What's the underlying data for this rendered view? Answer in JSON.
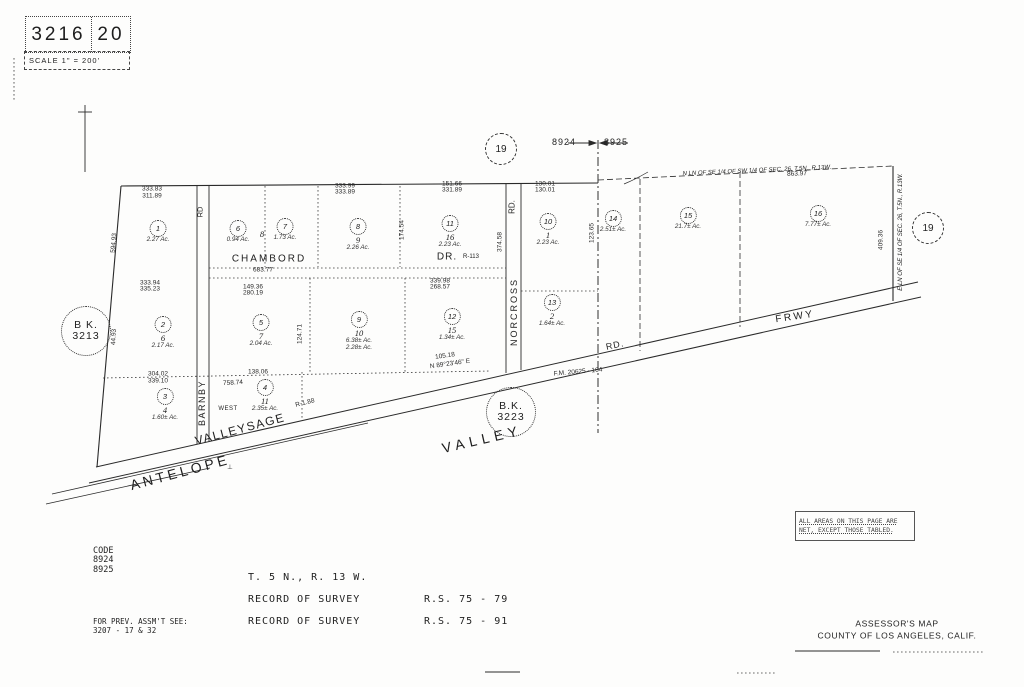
{
  "title_block": {
    "book": "3216",
    "page": "20",
    "scale": "SCALE 1\" = 200'"
  },
  "refs": {
    "map_circle_top": "19",
    "map_circle_right": "19",
    "page_left": "8924",
    "page_right": "8925",
    "bk_left_line1": "B K.",
    "bk_left_line2": "3213",
    "bk_mid_line1": "B.K.",
    "bk_mid_line2": "3223"
  },
  "section_lines": {
    "north": "N LN OF SE 1/4 OF SW 1/4 OF SEC. 26, T.5N., R.13W.",
    "east": "E LN OF SE 1/4 OF SEC. 26, T.5N., R.13W."
  },
  "roads": {
    "chambord": "CHAMBORD",
    "chambord_suffix": "DR.",
    "chambord_note": "R-113",
    "norcross": "NORCROSS",
    "norcross_suffix": "RD.",
    "barnby": "BARNBY",
    "barnby_suffix": "RD",
    "antelope": "ANTELOPE",
    "valley": "VALLEY",
    "valleysage": "VALLEYSAGE",
    "frwy": "FRWY",
    "diag_rd": "RD.",
    "west": "WEST",
    "lot8_label": "8"
  },
  "parcels": [
    {
      "circle": "1",
      "lot": "",
      "area": "2.27 Ac.",
      "x": 158,
      "y": 226
    },
    {
      "circle": "6",
      "lot": "",
      "area": "0.94 Ac.",
      "x": 238,
      "y": 226
    },
    {
      "circle": "7",
      "lot": "",
      "area": "1.73 Ac.",
      "x": 285,
      "y": 224
    },
    {
      "circle": "8",
      "lot": "9",
      "area": "2.26 Ac.",
      "x": 358,
      "y": 224
    },
    {
      "circle": "11",
      "lot": "16",
      "area": "2.23 Ac.",
      "x": 450,
      "y": 221
    },
    {
      "circle": "10",
      "lot": "1",
      "area": "2.23 Ac.",
      "x": 548,
      "y": 219
    },
    {
      "circle": "14",
      "lot": "",
      "area": "2.51± Ac.",
      "x": 613,
      "y": 216
    },
    {
      "circle": "15",
      "lot": "",
      "area": "21.7± Ac.",
      "x": 688,
      "y": 213
    },
    {
      "circle": "16",
      "lot": "",
      "area": "7.77± Ac.",
      "x": 818,
      "y": 211
    },
    {
      "circle": "2",
      "lot": "6",
      "area": "2.17 Ac.",
      "x": 163,
      "y": 322
    },
    {
      "circle": "5",
      "lot": "7",
      "area": "2.04 Ac.",
      "x": 261,
      "y": 320
    },
    {
      "circle": "9",
      "lot": "10",
      "area": "6.38± Ac.",
      "area2": "2.28± Ac.",
      "x": 359,
      "y": 317
    },
    {
      "circle": "12",
      "lot": "15",
      "area": "1.34± Ac.",
      "x": 452,
      "y": 314
    },
    {
      "circle": "13",
      "lot": "2",
      "area": "1.64± Ac.",
      "x": 552,
      "y": 300
    },
    {
      "circle": "3",
      "lot": "4",
      "area": "1.60± Ac.",
      "x": 165,
      "y": 394
    },
    {
      "circle": "4",
      "lot": "11",
      "area": "2.35± Ac.",
      "x": 265,
      "y": 385
    }
  ],
  "dimensions": [
    {
      "t": "333.83",
      "x": 152,
      "y": 189
    },
    {
      "t": "311.89",
      "x": 152,
      "y": 196
    },
    {
      "t": "333.99",
      "x": 345,
      "y": 186
    },
    {
      "t": "333.89",
      "x": 345,
      "y": 192
    },
    {
      "t": "151.66",
      "x": 452,
      "y": 184
    },
    {
      "t": "331.89",
      "x": 452,
      "y": 190
    },
    {
      "t": "130.01",
      "x": 545,
      "y": 184
    },
    {
      "t": "130.01",
      "x": 545,
      "y": 190
    },
    {
      "t": "863.97",
      "x": 797,
      "y": 174,
      "r": -2
    },
    {
      "t": "683.77",
      "x": 263,
      "y": 270
    },
    {
      "t": "339.98",
      "x": 440,
      "y": 281
    },
    {
      "t": "268.57",
      "x": 440,
      "y": 287
    },
    {
      "t": "149.36",
      "x": 253,
      "y": 287
    },
    {
      "t": "280.19",
      "x": 253,
      "y": 293
    },
    {
      "t": "333.94",
      "x": 150,
      "y": 283
    },
    {
      "t": "335.23",
      "x": 150,
      "y": 289
    },
    {
      "t": "304.02",
      "x": 158,
      "y": 374
    },
    {
      "t": "339.10",
      "x": 158,
      "y": 381
    },
    {
      "t": "138.06",
      "x": 258,
      "y": 372
    },
    {
      "t": "105.18",
      "x": 445,
      "y": 356,
      "r": -8
    },
    {
      "t": "N 89°23'46\" E",
      "x": 450,
      "y": 364,
      "r": -8
    },
    {
      "t": "758.74",
      "x": 233,
      "y": 383,
      "r": -3
    },
    {
      "t": "594.93",
      "x": 114,
      "y": 243,
      "r": -85
    },
    {
      "t": "44.93",
      "x": 114,
      "y": 337,
      "r": -87
    },
    {
      "t": "409.36",
      "x": 881,
      "y": 240,
      "r": -90
    },
    {
      "t": "124.71",
      "x": 300,
      "y": 334,
      "r": -90
    },
    {
      "t": "174.54",
      "x": 402,
      "y": 230,
      "r": -90
    },
    {
      "t": "374.58",
      "x": 500,
      "y": 242,
      "r": -90
    },
    {
      "t": "123.65",
      "x": 592,
      "y": 233,
      "r": -90
    },
    {
      "t": "F.M. 20625 - 164",
      "x": 578,
      "y": 372,
      "r": -5
    },
    {
      "t": "R-1.88",
      "x": 305,
      "y": 403,
      "r": -14
    },
    {
      "t": "⊥",
      "x": 230,
      "y": 467
    }
  ],
  "note_box": {
    "line1": "ALL AREAS ON THIS PAGE ARE",
    "line2": "NET, EXCEPT THOSE TABLED."
  },
  "footer": {
    "code_label": "CODE",
    "code1": "8924",
    "code2": "8925",
    "township": "T. 5 N., R. 13 W.",
    "survey1_label": "RECORD OF SURVEY",
    "survey1_ref": "R.S. 75 - 79",
    "survey2_label": "RECORD OF SURVEY",
    "survey2_ref": "R.S. 75 - 91",
    "prev_label": "FOR PREV. ASSM'T SEE:",
    "prev_ref": "3207 - 17 & 32",
    "map_title": "ASSESSOR'S MAP",
    "map_subtitle": "COUNTY OF LOS ANGELES, CALIF."
  }
}
